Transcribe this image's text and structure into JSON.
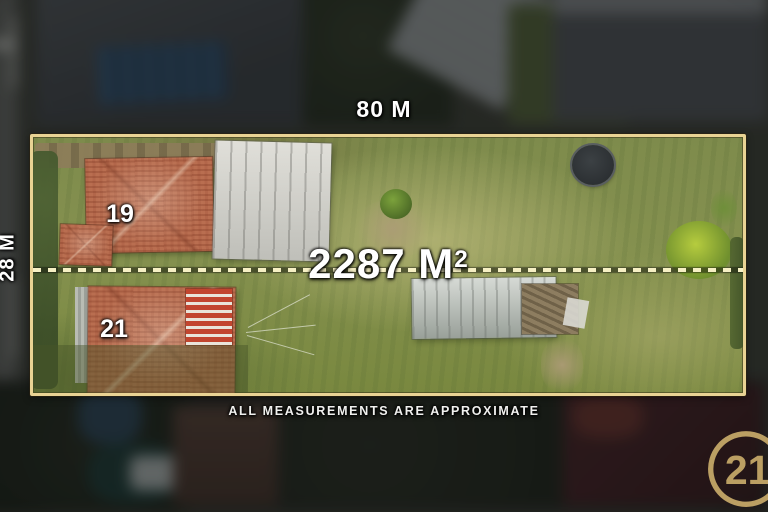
{
  "overlay": {
    "width_label": "80 M",
    "depth_label": "28 M",
    "area_value": "2287 M",
    "area_superscript": "2",
    "disclaimer": "ALL MEASUREMENTS ARE APPROXIMATE"
  },
  "lot": {
    "house_numbers": {
      "top": "19",
      "bottom": "21"
    },
    "features": [
      "house-19",
      "house-21",
      "garage",
      "shed",
      "trampoline",
      "boundary-dashed-line"
    ]
  },
  "branding": {
    "logo_number": "21",
    "logo_name": "century21-seal"
  },
  "colors": {
    "boundary_gold": "#e9d394",
    "dash_cream": "#f6f0c4",
    "logo_gold": "#bb9f63",
    "grass_green": "#81904f",
    "roof_terracotta": "#b96e50"
  }
}
